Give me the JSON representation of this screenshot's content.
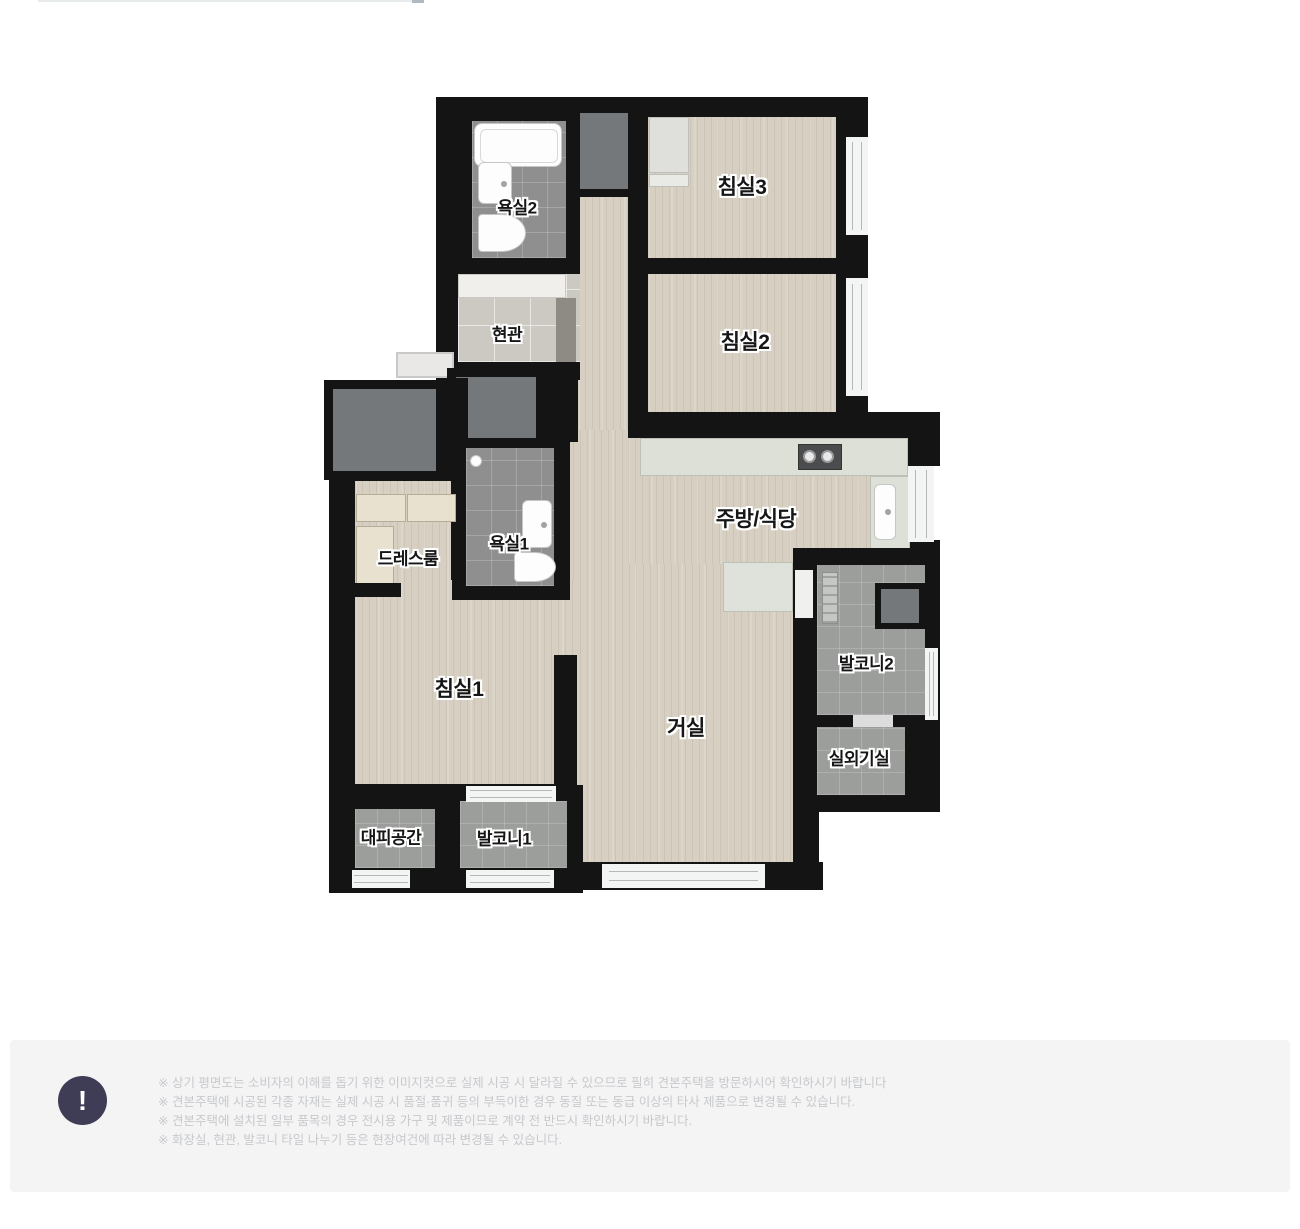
{
  "plan": {
    "rooms": {
      "bath2": "욕실2",
      "bed3": "침실3",
      "entrance": "현관",
      "bed2": "침실2",
      "dressroom": "드레스룸",
      "bath1": "욕실1",
      "kitchen": "주방/식당",
      "balcony2": "발코니2",
      "bed1": "침실1",
      "living": "거실",
      "outdoor_unit": "실외기실",
      "evacuation": "대피공간",
      "balcony1": "발코니1"
    }
  },
  "notice": {
    "icon_glyph": "!",
    "lines": [
      "※ 상기 평면도는 소비자의 이해를 돕기 위한 이미지컷으로 실제 시공 시 달라질 수 있으므로 필히 견본주택을 방문하시어 확인하시기 바랍니다",
      "※ 견본주택에 시공된 각종 자재는 실제 시공 시 품절·품귀 등의 부득이한 경우 동질 또는 동급 이상의 타사 제품으로 변경될 수 있습니다.",
      "※ 견본주택에 설치된 일부 품목의 경우 전시용 가구 및 제품이므로 계약 전 반드시 확인하시기 바랍니다.",
      "※ 화장실, 현관, 발코니 타일 나누기 등은 현장여건에 따라 변경될 수 있습니다."
    ]
  },
  "colors": {
    "wall": "#141414",
    "wood": "#d7d0c2",
    "tileGray": "#8f8f8f",
    "tileBalcony": "#9b9e9a",
    "tileEntry": "#ccc9c3",
    "boxGray": "#75787b",
    "counter": "#dce0d6",
    "window": "#f3f5f4",
    "noticeBg": "#f4f4f5",
    "noticeText": "#c7c9cc",
    "iconBg": "#3e3d55",
    "labelColor": "#161616"
  }
}
